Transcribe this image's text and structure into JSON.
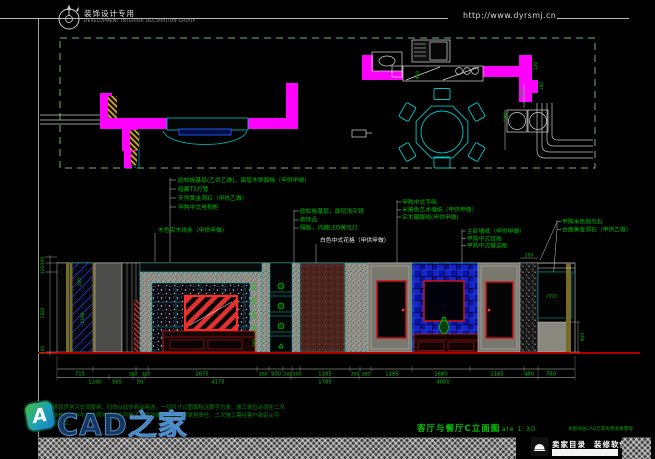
{
  "header": {
    "logo_title": "装饰设计专用",
    "logo_subtitle": "DEVELOPMENT INTERIOR DECORATION GROUP",
    "url": "http://www.dyrsmj.cn"
  },
  "plan": {
    "dims": {
      "d400": "400",
      "d120": "120",
      "d180": "180",
      "d520": "520",
      "d590": "590"
    }
  },
  "annotations": {
    "group1": [
      "欧松板基层(乙供乙做)，面层木饰面板（甲供甲做）",
      "暗藏T5灯管",
      "天然黄金洞石（甲供乙做）",
      "甲购中式电视柜"
    ],
    "left2": "木色实木线条（甲供甲做）",
    "group2": [
      "欧松板基层，面层浅灰镜",
      "装饰品",
      "隔板，内藏LED黄光灯"
    ],
    "white_label": "白色中式花格（甲供甲做）",
    "group3": [
      "甲购中式字画",
      "米黄色艺术墙纸（甲供甲做）",
      "实木踢脚线(甲供甲做)"
    ],
    "group4": [
      "主卧墙纸（甲供甲做）",
      "甲购中式挂画",
      "甲购中式餐边柜"
    ],
    "group5": [
      "甲购米色抛光石",
      "台面黄金洞石（甲供乙做）"
    ]
  },
  "elevation": {
    "left_dims": [
      "300",
      "100",
      "2320",
      "100"
    ],
    "inner_left_dims": [
      "200",
      "2100"
    ],
    "niche_dims": [
      "300",
      "200",
      "300",
      "200",
      "300"
    ],
    "top_right_dim": "200",
    "right_dim": "900",
    "cyan_mark": "7777",
    "dim_row1": [
      "715",
      "200",
      "300",
      "2875",
      "300",
      "500",
      "200",
      "300",
      "1185",
      "300",
      "300",
      "1185",
      "1680",
      "1185",
      "480",
      "760"
    ],
    "dim_row2": [
      "1240",
      "585",
      "50",
      "4175",
      "1785",
      "4050"
    ]
  },
  "title_block": {
    "title": "客厅与餐厅C立面图",
    "scale": "Scale  1:30",
    "credit": "本图纸由CAD之家免费收集整理"
  },
  "watermark": {
    "brand": "CAD之家",
    "icon_letter": "A",
    "disclaimer_line1": "本图纸仅供学习交流使用，切勿以此作商业用途。一切尺寸以图面标注数字为准，施工单位必须在二次",
    "disclaimer_line2": "现场复核确认并与设计师沟通后方可施工，否则施工单位必须承担责任。二次施工需经客户审定认可",
    "disclaimer_line3": "后方可施工。"
  },
  "footer": {
    "link1": "卖家目录",
    "link2": "装修软件"
  },
  "colors": {
    "wall_magenta": "#ff00ff",
    "line_cyan": "#00cccc",
    "text_green": "#00c000",
    "tv_red": "#dd2222",
    "watermark_blue": "#16365f"
  }
}
